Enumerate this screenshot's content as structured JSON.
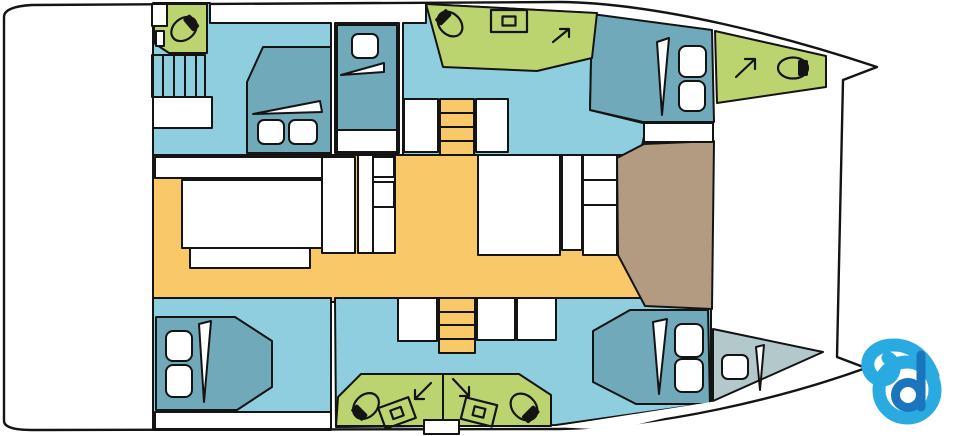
{
  "palette": {
    "line": "#141414",
    "room_blue": "#8FCEDF",
    "bed_teal": "#70A9B9",
    "berth_gray": "#B2C8CB",
    "wet_green": "#BCD470",
    "floor_orange": "#F9C869",
    "deck_brown": "#B29B80",
    "logo_light": "#29ABE2",
    "logo_dark": "#1B75BC"
  },
  "icons": {
    "toilet": "toilet",
    "sink": "sink",
    "deck_access_arrow": "deck access arrow",
    "stairs": "stairs",
    "bed_pillow": "pillow",
    "logo": "b"
  }
}
